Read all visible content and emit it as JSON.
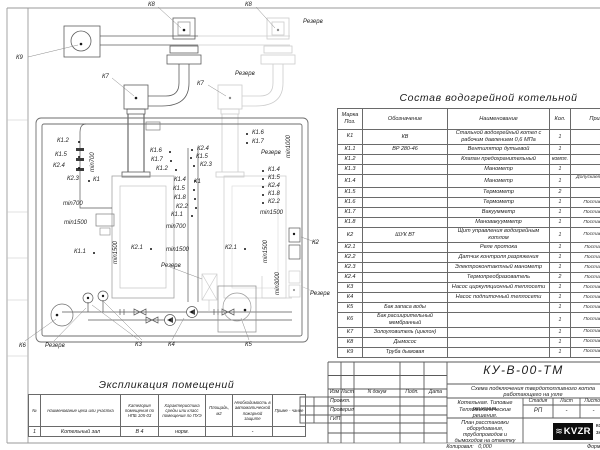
{
  "components_table": {
    "title": "Состав водогрейной котельной",
    "headers": [
      "Марка Поз.",
      "Обозначение",
      "Наименование",
      "Кол.",
      "Примечание"
    ],
    "rows": [
      {
        "mark": "К1",
        "code": "КВ",
        "name": "Стальной водогрейный котел с рабочим давлением 0,6 МПа",
        "qty": "1",
        "note": ""
      },
      {
        "mark": "К1.1",
        "code": "ВР 280-46",
        "name": "Вентилятор дутьевой",
        "qty": "1",
        "note": ""
      },
      {
        "mark": "К1.2",
        "code": "",
        "name": "Клапан предохранительный",
        "qty": "компл.",
        "note": ""
      },
      {
        "mark": "К1.3",
        "code": "",
        "name": "Манометр",
        "qty": "1",
        "note": ""
      },
      {
        "mark": "К1.4",
        "code": "",
        "name": "Манометр",
        "qty": "1",
        "note": "Допускается замена поз. К2.3"
      },
      {
        "mark": "К1.5",
        "code": "",
        "name": "Термометр",
        "qty": "2",
        "note": ""
      },
      {
        "mark": "К1.6",
        "code": "",
        "name": "Термометр",
        "qty": "1",
        "note": "Постав. по соглас."
      },
      {
        "mark": "К1.7",
        "code": "",
        "name": "Вакуумметр",
        "qty": "1",
        "note": "Постав. по соглас."
      },
      {
        "mark": "К1.8",
        "code": "",
        "name": "Мановакуумметр",
        "qty": "1",
        "note": "Постав. по соглас."
      },
      {
        "mark": "К2",
        "code": "ШУК ВТ",
        "name": "Щит управления водогрейным котлом",
        "qty": "1",
        "note": "Постав. по соглас."
      },
      {
        "mark": "К2.1",
        "code": "",
        "name": "Реле протока",
        "qty": "1",
        "note": "Постав. с ШУК ВТ"
      },
      {
        "mark": "К2.2",
        "code": "",
        "name": "Датчик контроля разряжения",
        "qty": "1",
        "note": "Постав. с ШУК ВТ"
      },
      {
        "mark": "К2.3",
        "code": "",
        "name": "Электроконтактный манометр",
        "qty": "1",
        "note": "Постав. с ШУК ВТ"
      },
      {
        "mark": "К2.4",
        "code": "",
        "name": "Термопреобразователь",
        "qty": "2",
        "note": "Постав. с ШУК ВТ"
      },
      {
        "mark": "К3",
        "code": "",
        "name": "Насос циркуляционный теплосети",
        "qty": "1",
        "note": "Постав. по соглас."
      },
      {
        "mark": "К4",
        "code": "",
        "name": "Насос подпиточный теплосети",
        "qty": "1",
        "note": "Постав. по соглас."
      },
      {
        "mark": "К5",
        "code": "Бак запаса воды",
        "name": "",
        "qty": "1",
        "note": "Постав. по соглас."
      },
      {
        "mark": "К6",
        "code": "Бак расширительный мембранный",
        "name": "",
        "qty": "1",
        "note": "Постав. по соглас."
      },
      {
        "mark": "К7",
        "code": "Золоуловитель (циклон)",
        "name": "",
        "qty": "1",
        "note": "Постав. по соглас."
      },
      {
        "mark": "К8",
        "code": "Дымосос",
        "name": "",
        "qty": "1",
        "note": "Постав. по соглас."
      },
      {
        "mark": "К9",
        "code": "Труба дымовая",
        "name": "",
        "qty": "1",
        "note": "Постав. по соглас."
      }
    ]
  },
  "rooms_table": {
    "title": "Экспликация помещений",
    "headers": [
      "№",
      "Наименование цеха или участка",
      "Категория помещения по НПБ 105-03",
      "Характеристика среды или класс помещения по ПУЭ",
      "Площадь, м2",
      "Необходимость в автоматической пожарной защите",
      "Приме - чание"
    ],
    "rows": [
      [
        "1",
        "Котельный зал",
        "В 4",
        "норм.",
        "",
        "-",
        ""
      ]
    ]
  },
  "title_block": {
    "doc_number": "КУ-В-00-ТМ",
    "subtitle": "Схема подключения твердотопливного котла работающего на угле",
    "project_line1": "Котельная. Типовые решения.",
    "project_line2": "Тепломеханические решения.",
    "sheet_title": "План расстановки оборудования, трубопроводов и дымоходов на отметку 0,000",
    "stage_label": "Стадия",
    "sheet_label": "Лист",
    "sheets_label": "Листов",
    "stage": "РП",
    "sheet": "-",
    "sheets": "-",
    "sig_headers": [
      "Изм",
      "Лист",
      "N докум",
      "Подп.",
      "Дата"
    ],
    "sig_rows": [
      "Проект.",
      "Проверил",
      "ГИП"
    ],
    "logo_text": "KVZR",
    "company_line1": "КОТЕЛЬНЫЙ",
    "company_line2": "ЗАВОД Р",
    "copied_label": "Копировал:",
    "format_label": "Формат"
  },
  "labels": [
    {
      "t": "К9",
      "x": 16,
      "y": 55
    },
    {
      "t": "К8",
      "x": 148,
      "y": 2
    },
    {
      "t": "К8",
      "x": 245,
      "y": 2
    },
    {
      "t": "К7",
      "x": 102,
      "y": 74
    },
    {
      "t": "К7",
      "x": 197,
      "y": 81
    },
    {
      "t": "Резерв",
      "x": 235,
      "y": 71
    },
    {
      "t": "Резерв",
      "x": 303,
      "y": 19
    },
    {
      "t": "К1.2",
      "x": 57,
      "y": 138,
      "d": [
        21,
        3
      ]
    },
    {
      "t": "К1.5",
      "x": 55,
      "y": 152,
      "d": [
        23,
        4
      ]
    },
    {
      "t": "К2.4",
      "x": 53,
      "y": 163,
      "d": [
        25,
        4
      ]
    },
    {
      "t": "К2.3",
      "x": 67,
      "y": 176,
      "d": [
        21,
        4
      ]
    },
    {
      "t": "К1",
      "x": 93,
      "y": 177
    },
    {
      "t": "min700",
      "x": 90,
      "y": 172,
      "r": 1
    },
    {
      "t": "min700",
      "x": 63,
      "y": 201
    },
    {
      "t": "min1500",
      "x": 64,
      "y": 220
    },
    {
      "t": "К1.6",
      "x": 150,
      "y": 148,
      "d": [
        19,
        3
      ]
    },
    {
      "t": "К1.7",
      "x": 151,
      "y": 157,
      "d": [
        19,
        3
      ]
    },
    {
      "t": "К1.2",
      "x": 156,
      "y": 166,
      "d": [
        19,
        3
      ]
    },
    {
      "t": "К2.4",
      "x": 197,
      "y": 146,
      "d": [
        -6,
        3
      ]
    },
    {
      "t": "К1.5",
      "x": 196,
      "y": 154,
      "d": [
        -6,
        3
      ]
    },
    {
      "t": "К2.3",
      "x": 200,
      "y": 162,
      "d": [
        -7,
        3
      ]
    },
    {
      "t": "К1.4",
      "x": 174,
      "y": 177,
      "d": [
        20,
        3
      ]
    },
    {
      "t": "К1",
      "x": 194,
      "y": 179
    },
    {
      "t": "К1.5",
      "x": 173,
      "y": 186,
      "d": [
        20,
        3
      ]
    },
    {
      "t": "К1.8",
      "x": 174,
      "y": 195,
      "d": [
        20,
        3
      ]
    },
    {
      "t": "К2.2",
      "x": 176,
      "y": 204,
      "d": [
        19,
        3
      ]
    },
    {
      "t": "К1.1",
      "x": 171,
      "y": 212,
      "d": [
        20,
        3
      ]
    },
    {
      "t": "min700",
      "x": 166,
      "y": 224
    },
    {
      "t": "К1.6",
      "x": 252,
      "y": 130,
      "d": [
        -6,
        3
      ]
    },
    {
      "t": "К1.7",
      "x": 252,
      "y": 139,
      "d": [
        -6,
        3
      ]
    },
    {
      "t": "Резерв",
      "x": 261,
      "y": 150
    },
    {
      "t": "min1000",
      "x": 286,
      "y": 158,
      "r": 1
    },
    {
      "t": "К1.4",
      "x": 268,
      "y": 167,
      "d": [
        -6,
        3
      ]
    },
    {
      "t": "К1.5",
      "x": 268,
      "y": 175,
      "d": [
        -6,
        3
      ]
    },
    {
      "t": "К2.4",
      "x": 268,
      "y": 183,
      "d": [
        -6,
        3
      ]
    },
    {
      "t": "К1.8",
      "x": 268,
      "y": 191,
      "d": [
        -6,
        3
      ]
    },
    {
      "t": "К2.2",
      "x": 268,
      "y": 199,
      "d": [
        -6,
        3
      ]
    },
    {
      "t": "min1500",
      "x": 260,
      "y": 210
    },
    {
      "t": "К1.1",
      "x": 74,
      "y": 249,
      "d": [
        19,
        3
      ]
    },
    {
      "t": "min1500",
      "x": 113,
      "y": 264,
      "r": 1
    },
    {
      "t": "К2.1",
      "x": 131,
      "y": 245,
      "d": [
        19,
        3
      ]
    },
    {
      "t": "min1500",
      "x": 166,
      "y": 247
    },
    {
      "t": "К2.1",
      "x": 225,
      "y": 245,
      "d": [
        19,
        3
      ]
    },
    {
      "t": "min1500",
      "x": 263,
      "y": 263,
      "r": 1
    },
    {
      "t": "Резерв",
      "x": 161,
      "y": 263
    },
    {
      "t": "min3000",
      "x": 275,
      "y": 295,
      "r": 1
    },
    {
      "t": "К2",
      "x": 312,
      "y": 240
    },
    {
      "t": "Резерв",
      "x": 310,
      "y": 291
    },
    {
      "t": "К6",
      "x": 19,
      "y": 343
    },
    {
      "t": "Резерв",
      "x": 45,
      "y": 343
    },
    {
      "t": "К3",
      "x": 135,
      "y": 342
    },
    {
      "t": "К4",
      "x": 168,
      "y": 342
    },
    {
      "t": "К5",
      "x": 245,
      "y": 342
    }
  ]
}
